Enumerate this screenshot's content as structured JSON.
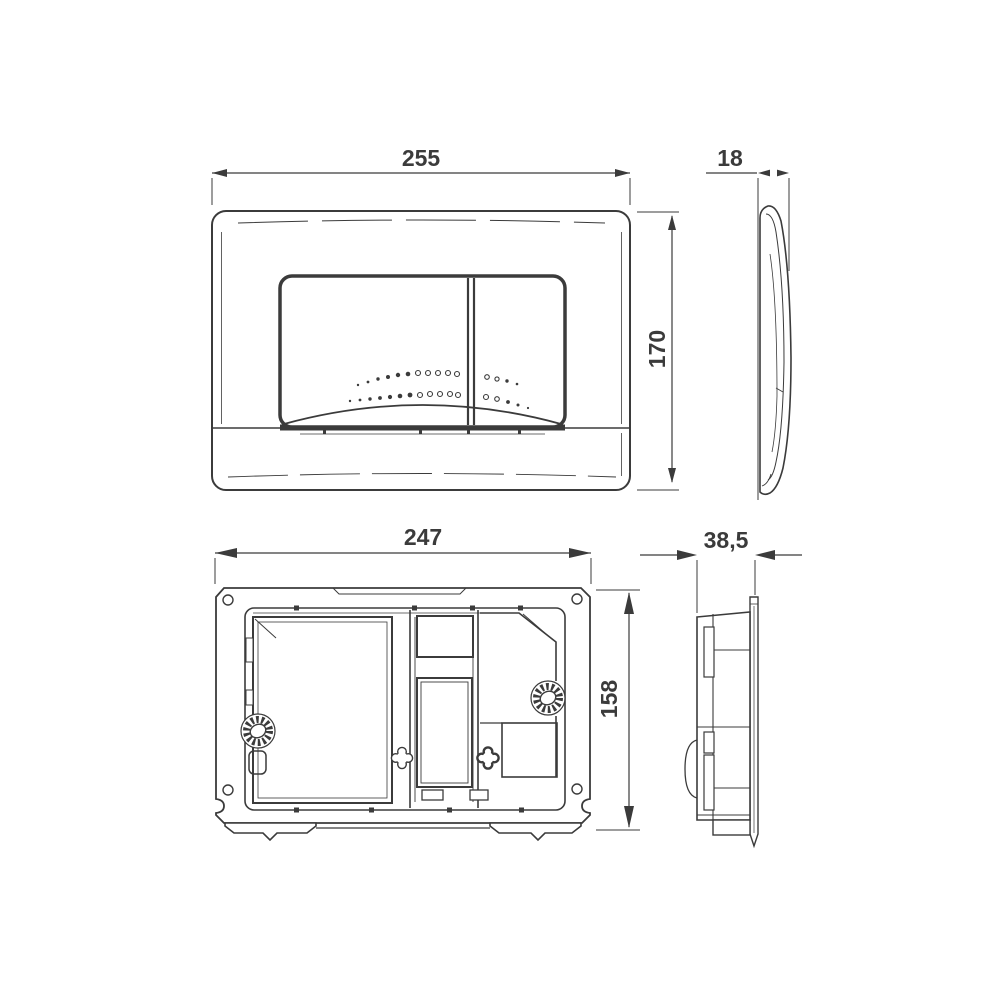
{
  "page": {
    "background": "#ffffff"
  },
  "drawing": {
    "stroke_color": "#3b3b3b",
    "text_color": "#3b3b3b",
    "dimensions": {
      "front_width": "255",
      "front_height": "170",
      "plate_depth": "18",
      "frame_width": "247",
      "frame_height": "158",
      "frame_depth": "38,5"
    },
    "views": {
      "front": "flush-plate-front-view",
      "plate_side": "flush-plate-side-profile",
      "frame_back": "mounting-frame-back-view",
      "frame_side": "mounting-frame-side-profile"
    },
    "dots": {
      "left_row_a": [
        [
          358,
          385,
          1.2,
          0
        ],
        [
          368,
          382,
          1.4,
          0
        ],
        [
          378,
          379,
          1.7,
          0
        ],
        [
          388,
          377,
          2.0,
          0
        ],
        [
          398,
          375,
          2.2,
          0
        ],
        [
          408,
          374,
          2.3,
          0
        ],
        [
          418,
          373,
          2.5,
          1
        ],
        [
          428,
          373,
          2.5,
          1
        ],
        [
          438,
          373,
          2.5,
          1
        ],
        [
          448,
          373,
          2.5,
          1
        ],
        [
          457,
          374,
          2.5,
          1
        ]
      ],
      "left_row_b": [
        [
          350,
          401,
          1.2,
          0
        ],
        [
          360,
          400,
          1.4,
          0
        ],
        [
          370,
          399,
          1.7,
          0
        ],
        [
          380,
          398,
          1.9,
          0
        ],
        [
          390,
          397,
          2.1,
          0
        ],
        [
          400,
          396,
          2.3,
          0
        ],
        [
          410,
          395,
          2.4,
          0
        ],
        [
          420,
          395,
          2.5,
          1
        ],
        [
          430,
          394,
          2.5,
          1
        ],
        [
          440,
          394,
          2.5,
          1
        ],
        [
          450,
          394,
          2.5,
          1
        ],
        [
          458,
          395,
          2.5,
          1
        ]
      ],
      "right_row_a": [
        [
          487,
          377,
          2.3,
          1
        ],
        [
          497,
          379,
          2.1,
          1
        ],
        [
          507,
          381,
          1.7,
          0
        ],
        [
          517,
          384,
          1.3,
          0
        ]
      ],
      "right_row_b": [
        [
          486,
          397,
          2.5,
          1
        ],
        [
          497,
          399,
          2.3,
          1
        ],
        [
          508,
          402,
          1.9,
          0
        ],
        [
          518,
          405,
          1.5,
          0
        ],
        [
          528,
          408,
          1.1,
          0
        ]
      ]
    }
  }
}
